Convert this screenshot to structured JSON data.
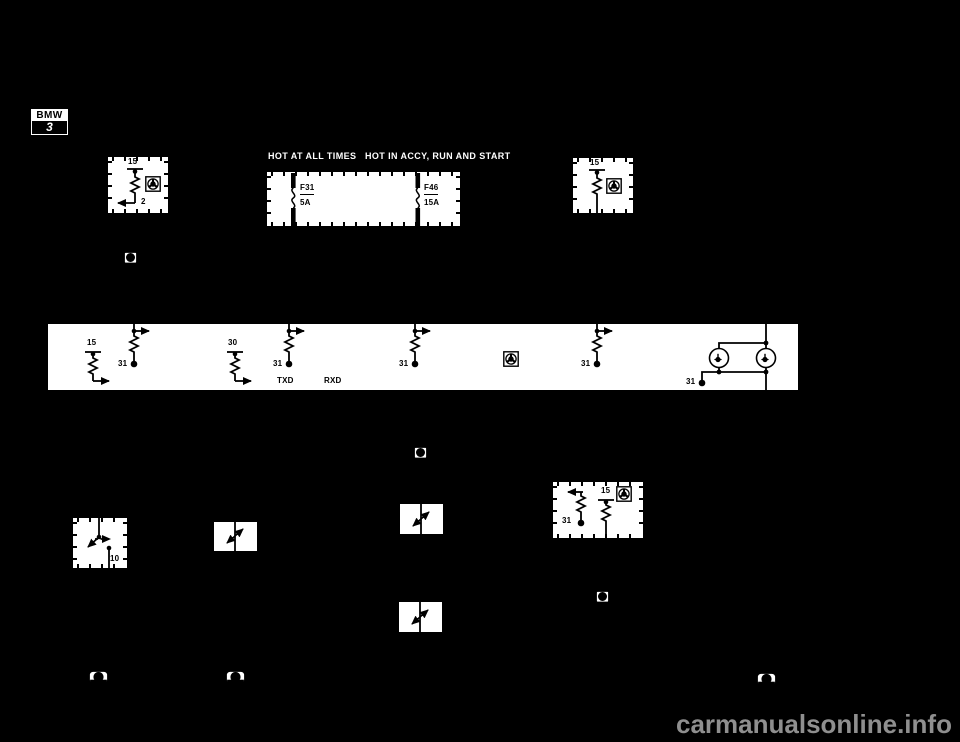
{
  "logo": {
    "brand": "BMW",
    "series": "3"
  },
  "power_headers": {
    "left": "HOT AT ALL TIMES",
    "right": "HOT IN ACCY, RUN AND START"
  },
  "fuse_panel": {
    "fuse1_name": "F31",
    "fuse1_rating": "5A",
    "fuse2_name": "F46",
    "fuse2_rating": "15A"
  },
  "top_left_box": {
    "terminal": "15",
    "pin": "2"
  },
  "top_right_box": {
    "terminal": "15"
  },
  "control_band": {
    "frag1_terminal": "15",
    "frag2_ground": "31",
    "frag3_terminal": "30",
    "frag4_ground": "31",
    "bus_txd": "TXD",
    "bus_rxd": "RXD",
    "frag5_ground": "31",
    "frag6_ground": "31",
    "lamps_ground": "31"
  },
  "switch_box": {
    "pin": "10"
  },
  "mid_right_box": {
    "ground": "31",
    "terminal": "15"
  },
  "watermark": {
    "text": "carmanualsonline.info"
  },
  "colors": {
    "background": "#000000",
    "box_fill": "#ffffff",
    "line": "#000000",
    "header_text": "#ffffff",
    "watermark": "#8f8f8f"
  }
}
